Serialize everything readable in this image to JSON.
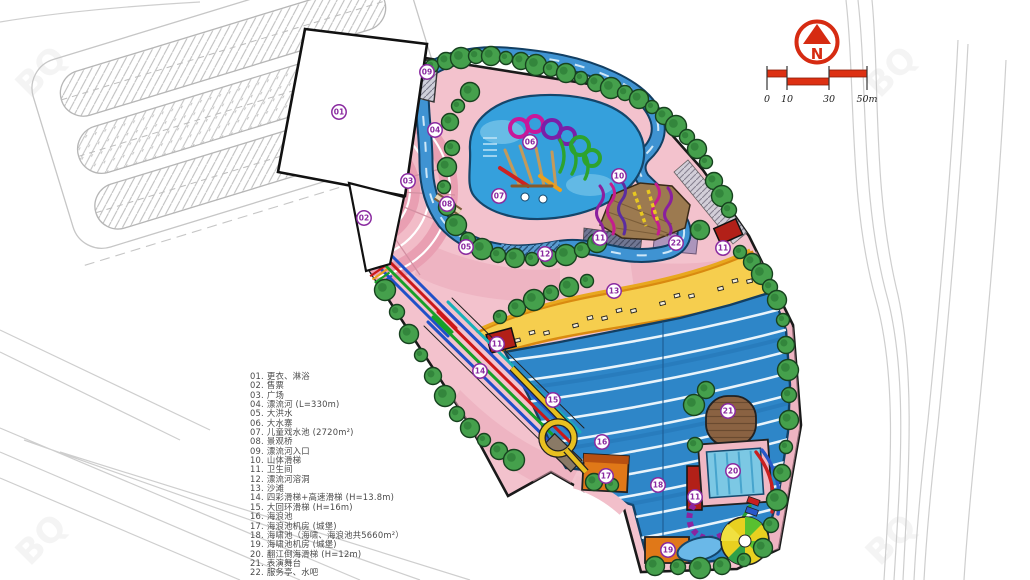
{
  "legend": {
    "items": [
      {
        "no": "01.",
        "text": "更衣、淋浴"
      },
      {
        "no": "02.",
        "text": "售票"
      },
      {
        "no": "03.",
        "text": "广场"
      },
      {
        "no": "04.",
        "text": "漂流河 (L=330m)"
      },
      {
        "no": "05.",
        "text": "大洪水"
      },
      {
        "no": "06.",
        "text": "大水寨"
      },
      {
        "no": "07.",
        "text": "儿童戏水池 (2720m²)"
      },
      {
        "no": "08.",
        "text": "景观桥"
      },
      {
        "no": "09.",
        "text": "漂流河入口"
      },
      {
        "no": "10.",
        "text": "山体滑梯"
      },
      {
        "no": "11.",
        "text": "卫生间"
      },
      {
        "no": "12.",
        "text": "漂流河溶洞"
      },
      {
        "no": "13.",
        "text": "沙滩"
      },
      {
        "no": "14.",
        "text": "四彩滑梯+高速滑梯 (H=13.8m)"
      },
      {
        "no": "15.",
        "text": "大回环滑梯 (H=16m)"
      },
      {
        "no": "16.",
        "text": "海浪池"
      },
      {
        "no": "17.",
        "text": "海浪池机房 (城堡)"
      },
      {
        "no": "18.",
        "text": "海啸池（海啸、海浪池共5660m²）"
      },
      {
        "no": "19.",
        "text": "海啸池机房 (城堡)"
      },
      {
        "no": "20.",
        "text": "翻江倒海滑梯 (H=12m)"
      },
      {
        "no": "21.",
        "text": "表演舞台"
      },
      {
        "no": "22.",
        "text": "服务亭、水吧"
      }
    ]
  },
  "plan_labels": [
    {
      "n": "01",
      "x": 339,
      "y": 112
    },
    {
      "n": "02",
      "x": 364,
      "y": 218
    },
    {
      "n": "03",
      "x": 408,
      "y": 181
    },
    {
      "n": "04",
      "x": 435,
      "y": 130
    },
    {
      "n": "05",
      "x": 466,
      "y": 247
    },
    {
      "n": "06",
      "x": 530,
      "y": 142
    },
    {
      "n": "07",
      "x": 499,
      "y": 196
    },
    {
      "n": "08",
      "x": 447,
      "y": 204
    },
    {
      "n": "09",
      "x": 427,
      "y": 72
    },
    {
      "n": "10",
      "x": 619,
      "y": 176
    },
    {
      "n": "11",
      "x": 600,
      "y": 238
    },
    {
      "n": "11",
      "x": 723,
      "y": 248
    },
    {
      "n": "11",
      "x": 497,
      "y": 344
    },
    {
      "n": "11",
      "x": 695,
      "y": 497
    },
    {
      "n": "12",
      "x": 545,
      "y": 254
    },
    {
      "n": "13",
      "x": 614,
      "y": 291
    },
    {
      "n": "14",
      "x": 480,
      "y": 371
    },
    {
      "n": "15",
      "x": 553,
      "y": 400
    },
    {
      "n": "16",
      "x": 602,
      "y": 442
    },
    {
      "n": "17",
      "x": 606,
      "y": 476
    },
    {
      "n": "18",
      "x": 658,
      "y": 485
    },
    {
      "n": "19",
      "x": 668,
      "y": 550
    },
    {
      "n": "20",
      "x": 733,
      "y": 471
    },
    {
      "n": "21",
      "x": 728,
      "y": 411
    },
    {
      "n": "22",
      "x": 676,
      "y": 243
    }
  ],
  "north_arrow": {
    "letter": "N"
  },
  "scale_bar": {
    "ticks": [
      {
        "label": "0",
        "x": 767
      },
      {
        "label": "10",
        "x": 787
      },
      {
        "label": "30",
        "x": 829
      },
      {
        "label": "50m",
        "x": 867
      }
    ]
  },
  "watermark": {
    "text": "BQ"
  },
  "colors": {
    "label": "#8a2aa0",
    "scale_red": "#dd3012",
    "north_red": "#d62b12",
    "park_pink": "#f3c2cd",
    "river_blue": "#3f93d2",
    "pool_blue": "#2e86c8",
    "beach_yellow": "#f6ce4e",
    "tree_green": "#45a04c"
  }
}
